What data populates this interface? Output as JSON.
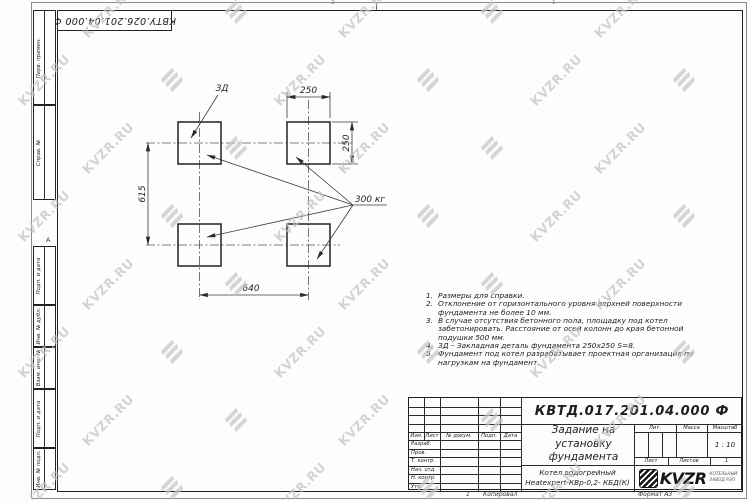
{
  "watermark": {
    "text": "KVZR.RU"
  },
  "stamp_top": {
    "designation_rotated": "КВТУ.026.201.04.000 Ф"
  },
  "zones": {
    "top_left": "2",
    "top_right": "1",
    "left": "А"
  },
  "side_columns": [
    "Перв. примен.",
    "Справ. №",
    "Подп. и дата",
    "Инв. № дубл.",
    "Взам. инв. №",
    "Подп. и дата",
    "Инв. № подл."
  ],
  "drawing": {
    "dim_top": "250",
    "dim_right": "250",
    "dim_left": "615",
    "dim_bottom": "640",
    "embed_label": "ЗД",
    "load_label": "300 кг"
  },
  "notes": [
    {
      "num": "1",
      "lines": [
        "Размеры для справки."
      ]
    },
    {
      "num": "2",
      "lines": [
        "Отклонение от горизонтального уровня верхней поверхности",
        "фундамента не более 10 мм."
      ]
    },
    {
      "num": "3",
      "lines": [
        "В случае отсутствия бетонного пола, площадку под котел",
        "забетонировать. Расстояние от осей колонн до края бетонной",
        "подушки 500 мм."
      ]
    },
    {
      "num": "4",
      "lines": [
        "ЗД – Закладная деталь фундамента 250х250 S=8."
      ]
    },
    {
      "num": "5",
      "lines": [
        "Фундамент под котел разрабатывает проектная организация по",
        "нагрузкам на фундамент."
      ]
    }
  ],
  "title_block": {
    "designation": "КВТД.017.201.04.000 Ф",
    "doc_title": "Задание на установку фундамента",
    "product_line1": "Котел водогрейный",
    "product_line2": "Heatexpert-КВр-0,2- КБД(К)",
    "header": {
      "izm": "Изм.",
      "list": "Лист",
      "doc_num": "№ докум.",
      "podp": "Подп.",
      "data": "Дата"
    },
    "roles": [
      "Разраб.",
      "Пров.",
      "Т. контр.",
      "Нач. отд.",
      "Н. контр.",
      "Утв."
    ],
    "lit_label": "Лит.",
    "mass_label": "Масса",
    "scale_label": "Масштаб",
    "scale_value": "1 : 10",
    "sheet_label": "Лист",
    "sheets_label": "Листов",
    "sheets_value": "1",
    "logo_text": "KVZR",
    "logo_sub1": "КОТЕЛЬНЫЙ",
    "logo_sub2": "ЗАВОД РЭП"
  },
  "footer": {
    "copy": "1",
    "copied": "Копировал",
    "format": "Формат А3"
  }
}
